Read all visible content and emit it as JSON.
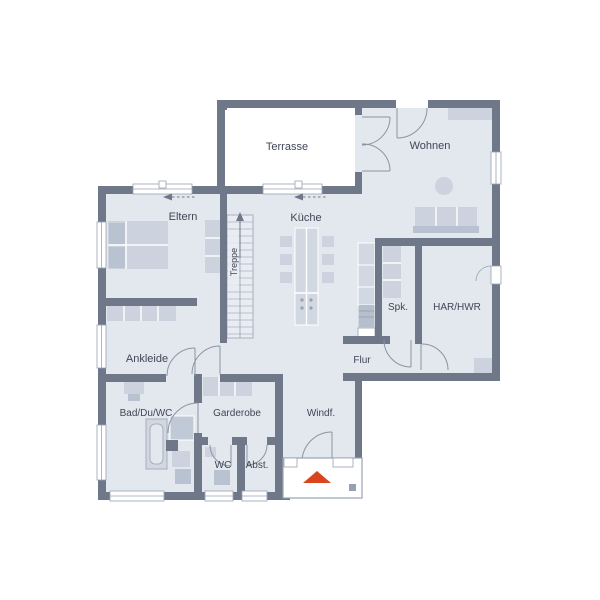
{
  "title": "Erdgeschoss Grundriss",
  "labels": {
    "terrasse": "Terrasse",
    "wohnen": "Wohnen",
    "eltern": "Eltern",
    "kueche": "Küche",
    "treppe": "Treppe",
    "spk": "Spk.",
    "har_hwr": "HAR/HWR",
    "ankleide": "Ankleide",
    "flur": "Flur",
    "bad_du_wc": "Bad/Du/WC",
    "garderobe": "Garderobe",
    "windfang": "Windf.",
    "wc": "WC",
    "abstellraum": "Abst."
  },
  "colors": {
    "background": "#ffffff",
    "wall": "#6e7889",
    "room": "#e3e7ee",
    "furn": "#ccd3de",
    "furn-dark": "#b9c2d0",
    "line": "#9aa3b2",
    "accent": "#d9451c",
    "label": "#3f4756"
  },
  "icons": {
    "entrance_arrow": "triangle-up",
    "stairs_up_arrow": "arrow-up",
    "sliding_window_arrow": "arrow-left-dashed"
  }
}
